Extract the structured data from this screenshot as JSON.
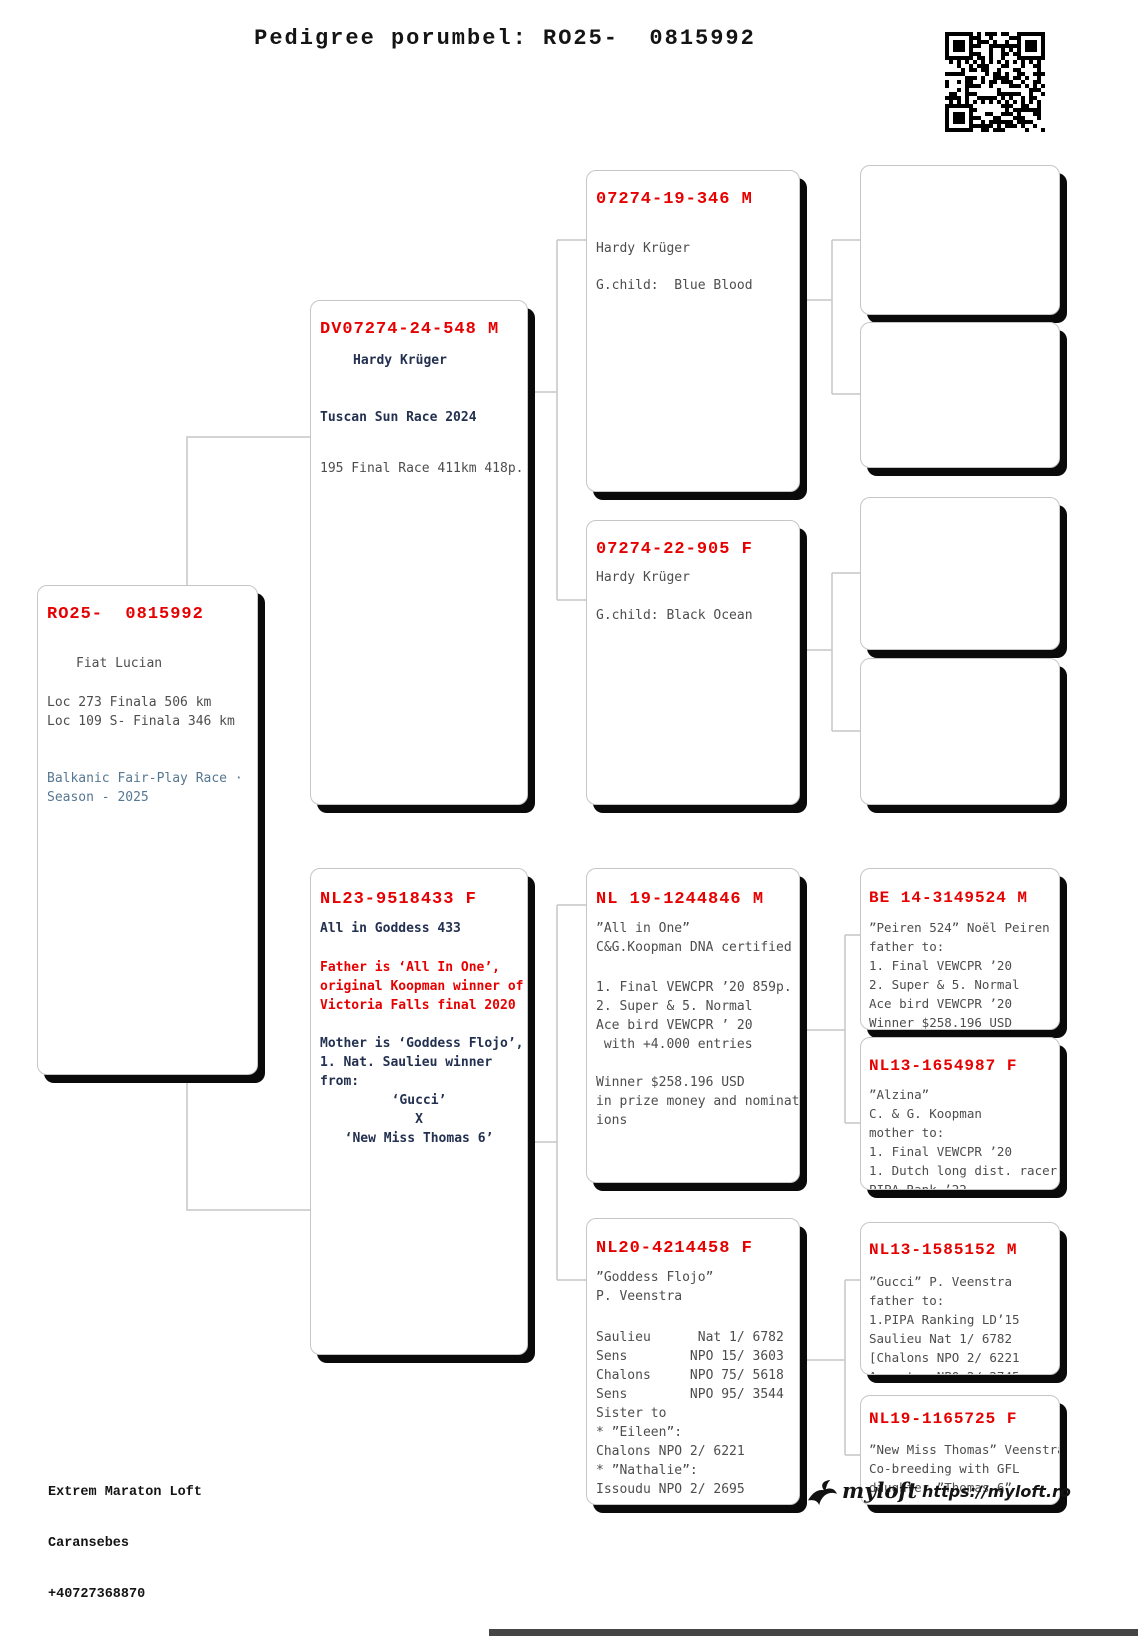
{
  "title": "Pedigree porumbel: RO25-  0815992",
  "colors": {
    "ring_red": "#e60000",
    "navy": "#233050",
    "body_gray": "#4d4d4d",
    "blue_gray": "#567792",
    "box_shadow": "#0a0a0a",
    "connector_gray": "#c6c6c6"
  },
  "subject": {
    "ring": "RO25-  0815992",
    "owner": "Fiat Lucian",
    "loc1": "Loc 273 Finala 506 km",
    "loc2": "Loc 109 S- Finala 346 km",
    "race1": "Balkanic Fair-Play Race ·",
    "race2": "Season - 2025"
  },
  "sire": {
    "ring": "DV07274-24-548 M",
    "name": "Hardy Krüger",
    "race": "Tuscan Sun Race 2024",
    "result": "195 Final Race 411km 418p."
  },
  "dam": {
    "ring": "NL23-9518433 F",
    "name": "All in Goddess 433",
    "father_note": [
      "Father is ‘All In One’,",
      "original Koopman winner of",
      "Victoria Falls final 2020"
    ],
    "mother_note": [
      "Mother is ‘Goddess Flojo’,",
      "1. Nat. Saulieu winner",
      "from:"
    ],
    "cross": [
      "‘Gucci’",
      "X",
      "‘New Miss Thomas 6’"
    ]
  },
  "gen3": {
    "sire_sire": {
      "ring": "07274-19-346 M",
      "lines": [
        "Hardy Krüger",
        "G.child:  Blue Blood"
      ]
    },
    "sire_dam": {
      "ring": "07274-22-905 F",
      "lines": [
        "Hardy Krüger",
        "G.child: Black Ocean"
      ]
    },
    "dam_sire": {
      "ring": "NL 19-1244846 M",
      "lines": [
        "”All in One”",
        "C&G.Koopman DNA certified",
        "1. Final VEWCPR ’20 859p.",
        "2. Super & 5. Normal",
        "Ace bird VEWCPR ’ 20",
        " with +4.000 entries",
        "Winner $258.196 USD",
        "in prize money and nominat",
        "ions"
      ]
    },
    "dam_dam": {
      "ring": "NL20-4214458 F",
      "lines": [
        "”Goddess Flojo”",
        "P. Veenstra",
        "Saulieu      Nat 1/ 6782",
        "Sens        NPO 15/ 3603",
        "Chalons     NPO 75/ 5618",
        "Sens        NPO 95/ 3544",
        "Sister to",
        "* ”Eileen”:",
        "Chalons NPO 2/ 6221",
        "* ”Nathalie”:",
        "Issoudu NPO 2/ 2695"
      ]
    }
  },
  "gen4": {
    "dam_sire_sire": {
      "ring": "BE 14-3149524 M",
      "lines": [
        "”Peiren 524” Noël Peiren",
        "father to:",
        "1. Final VEWCPR ’20",
        "2. Super & 5. Normal",
        "Ace bird VEWCPR ’20",
        "Winner $258.196 USD"
      ]
    },
    "dam_sire_dam": {
      "ring": "NL13-1654987 F",
      "lines": [
        "”Alzina”",
        "C. & G. Koopman",
        "mother to:",
        "1. Final VEWCPR ’20",
        "1. Dutch long dist. racer",
        "PIPA Rank.’22"
      ]
    },
    "dam_dam_sire": {
      "ring": "NL13-1585152 M",
      "lines": [
        "”Gucci” P. Veenstra",
        "father to:",
        "1.PIPA Ranking LD’15",
        "Saulieu Nat 1/ 6782",
        "[Chalons NPO 2/ 6221",
        "Argenton NPO 2/ 2745"
      ]
    },
    "dam_dam_dam": {
      "ring": "NL19-1165725 F",
      "lines": [
        "”New Miss Thomas” Veenstra",
        "Co-breeding with GFL",
        "daughter ”Thomas 6”"
      ]
    }
  },
  "footer": {
    "loft": "Extrem Maraton Loft",
    "city": "Caransebes",
    "phone": "+40727368870",
    "email": "lucianfiat@yahoo.com"
  },
  "brand": {
    "logo_text": "myloft",
    "url": "https://myloft.ro"
  }
}
